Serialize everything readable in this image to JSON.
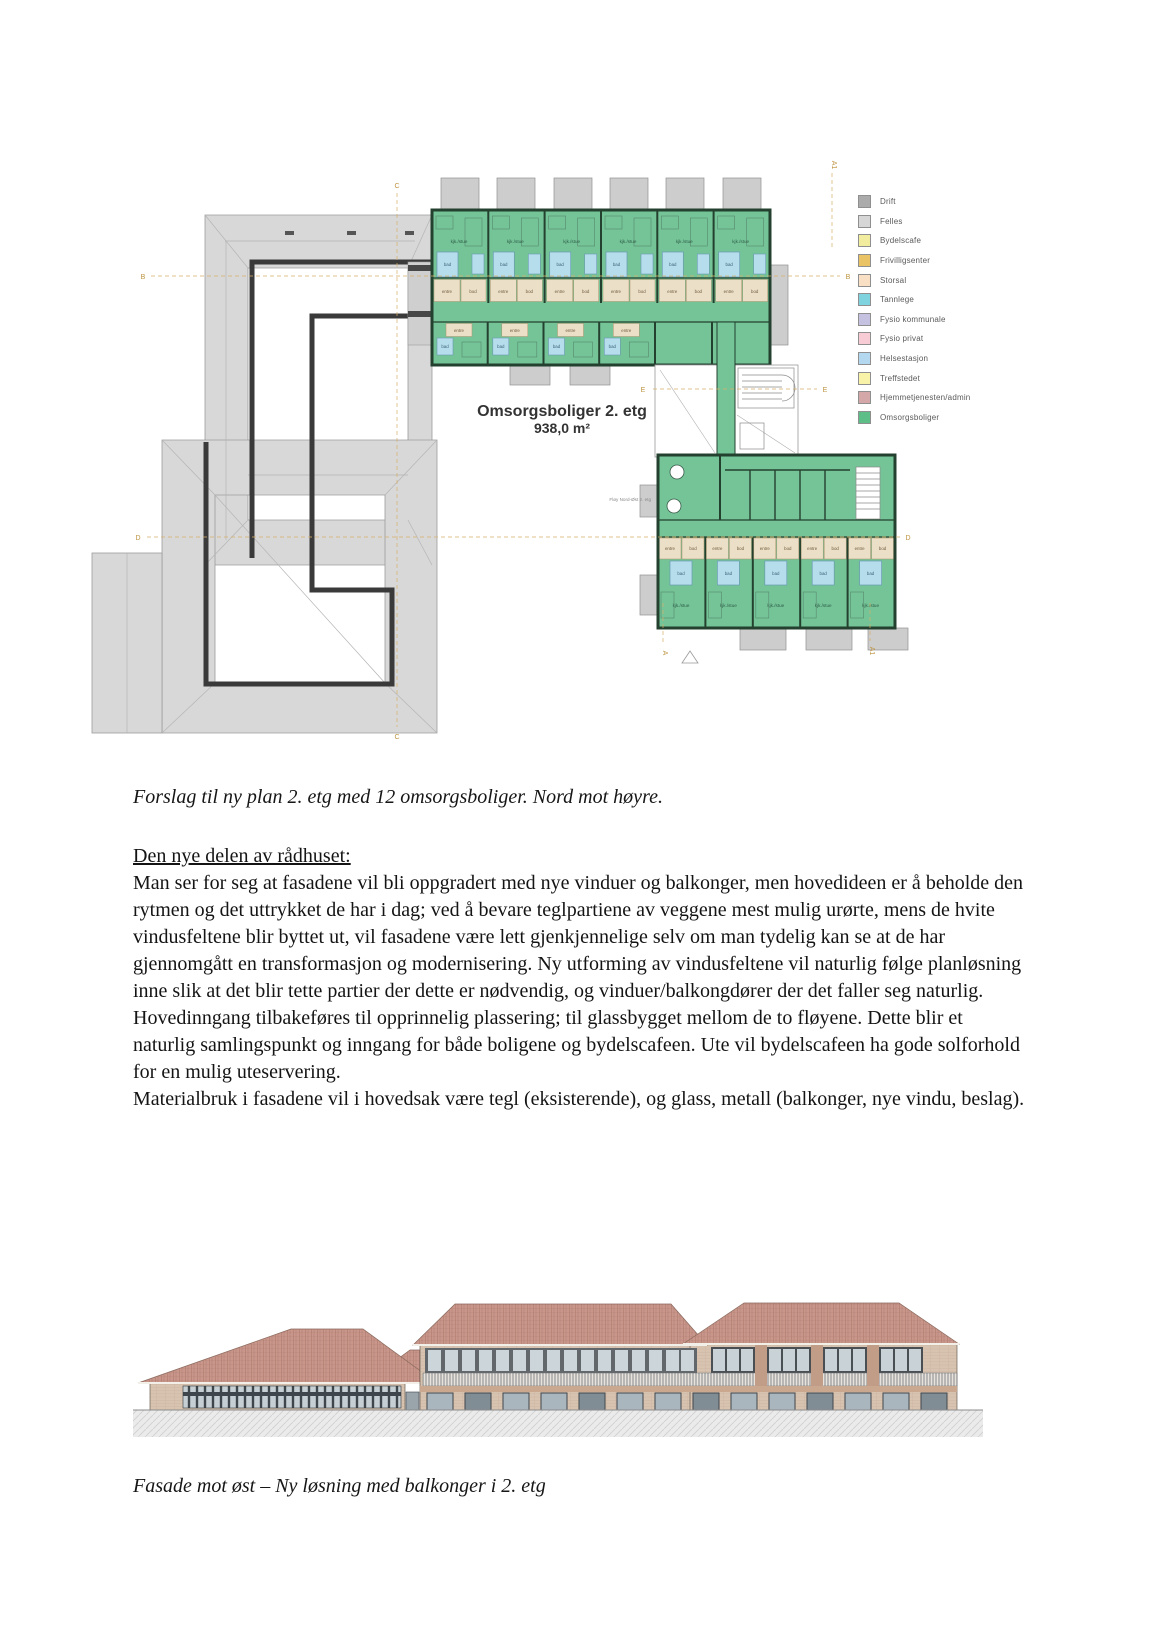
{
  "captions": {
    "plan": "Forslag til ny plan 2. etg med 12 omsorgsboliger. Nord mot høyre.",
    "facade": "Fasade mot øst – Ny løsning med balkonger i 2. etg"
  },
  "body": {
    "heading": "Den nye delen av rådhuset:",
    "paragraph1": "Man ser for seg at fasadene vil bli oppgradert med nye vinduer og balkonger, men hovedideen er å beholde den rytmen og det uttrykket de har i dag; ved å bevare teglpartiene av veggene mest mulig urørte, mens de hvite vindusfeltene blir byttet ut, vil fasadene være lett gjenkjennelige selv om man tydelig kan se at de har gjennomgått en transformasjon og modernisering. Ny utforming av vindusfeltene vil naturlig følge planløsning inne slik at det blir tette partier der dette er nødvendig, og vinduer/balkongdører der det faller seg naturlig. Hovedinngang tilbakeføres til opprinnelig plassering; til glassbygget mellom de to fløyene. Dette blir et naturlig samlingspunkt og inngang for både boligene og bydelscafeen. Ute vil bydelscafeen ha gode solforhold for en mulig uteservering.",
    "paragraph2": "Materialbruk i fasadene vil i hovedsak være tegl (eksisterende), og glass, metall (balkonger, nye vindu, beslag)."
  },
  "plan": {
    "title": "Omsorgsboliger 2. etg",
    "area": "938,0 m²",
    "wing_label": "Fløy Nord-Øst 2. etg",
    "grid_labels": {
      "a": "A",
      "a1": "A1",
      "b": "B",
      "c": "C",
      "d": "D",
      "e": "E"
    },
    "room_labels": {
      "bad": "bad",
      "bod": "bod",
      "entre": "entre",
      "kjk": "kjk./stue"
    }
  },
  "legend": {
    "items": [
      {
        "label": "Drift",
        "color": "#ababab"
      },
      {
        "label": "Felles",
        "color": "#d6d6d6"
      },
      {
        "label": "Bydelscafe",
        "color": "#f2ec9e"
      },
      {
        "label": "Frivilligsenter",
        "color": "#eac364"
      },
      {
        "label": "Storsal",
        "color": "#f9dfc4"
      },
      {
        "label": "Tannlege",
        "color": "#7fd3de"
      },
      {
        "label": "Fysio kommunale",
        "color": "#c4c1e1"
      },
      {
        "label": "Fysio privat",
        "color": "#f7ccd5"
      },
      {
        "label": "Helsestasjon",
        "color": "#b5d8f1"
      },
      {
        "label": "Treffstedet",
        "color": "#f9f3a9"
      },
      {
        "label": "Hjemmetjenesten/admin",
        "color": "#d4a8a8"
      },
      {
        "label": "Omsorgsboliger",
        "color": "#5dbe87"
      }
    ]
  },
  "colors": {
    "plan_green": "#74c498",
    "bath_blue": "#b6ddeb",
    "entry_beige": "#ecdfc7",
    "roof_gray": "#d8d8d8",
    "wall_dark": "#3a3a3a",
    "grid_tan": "#c8a055",
    "roof_tile": "#c8968a",
    "facade_brick": "#d7c3b0"
  }
}
